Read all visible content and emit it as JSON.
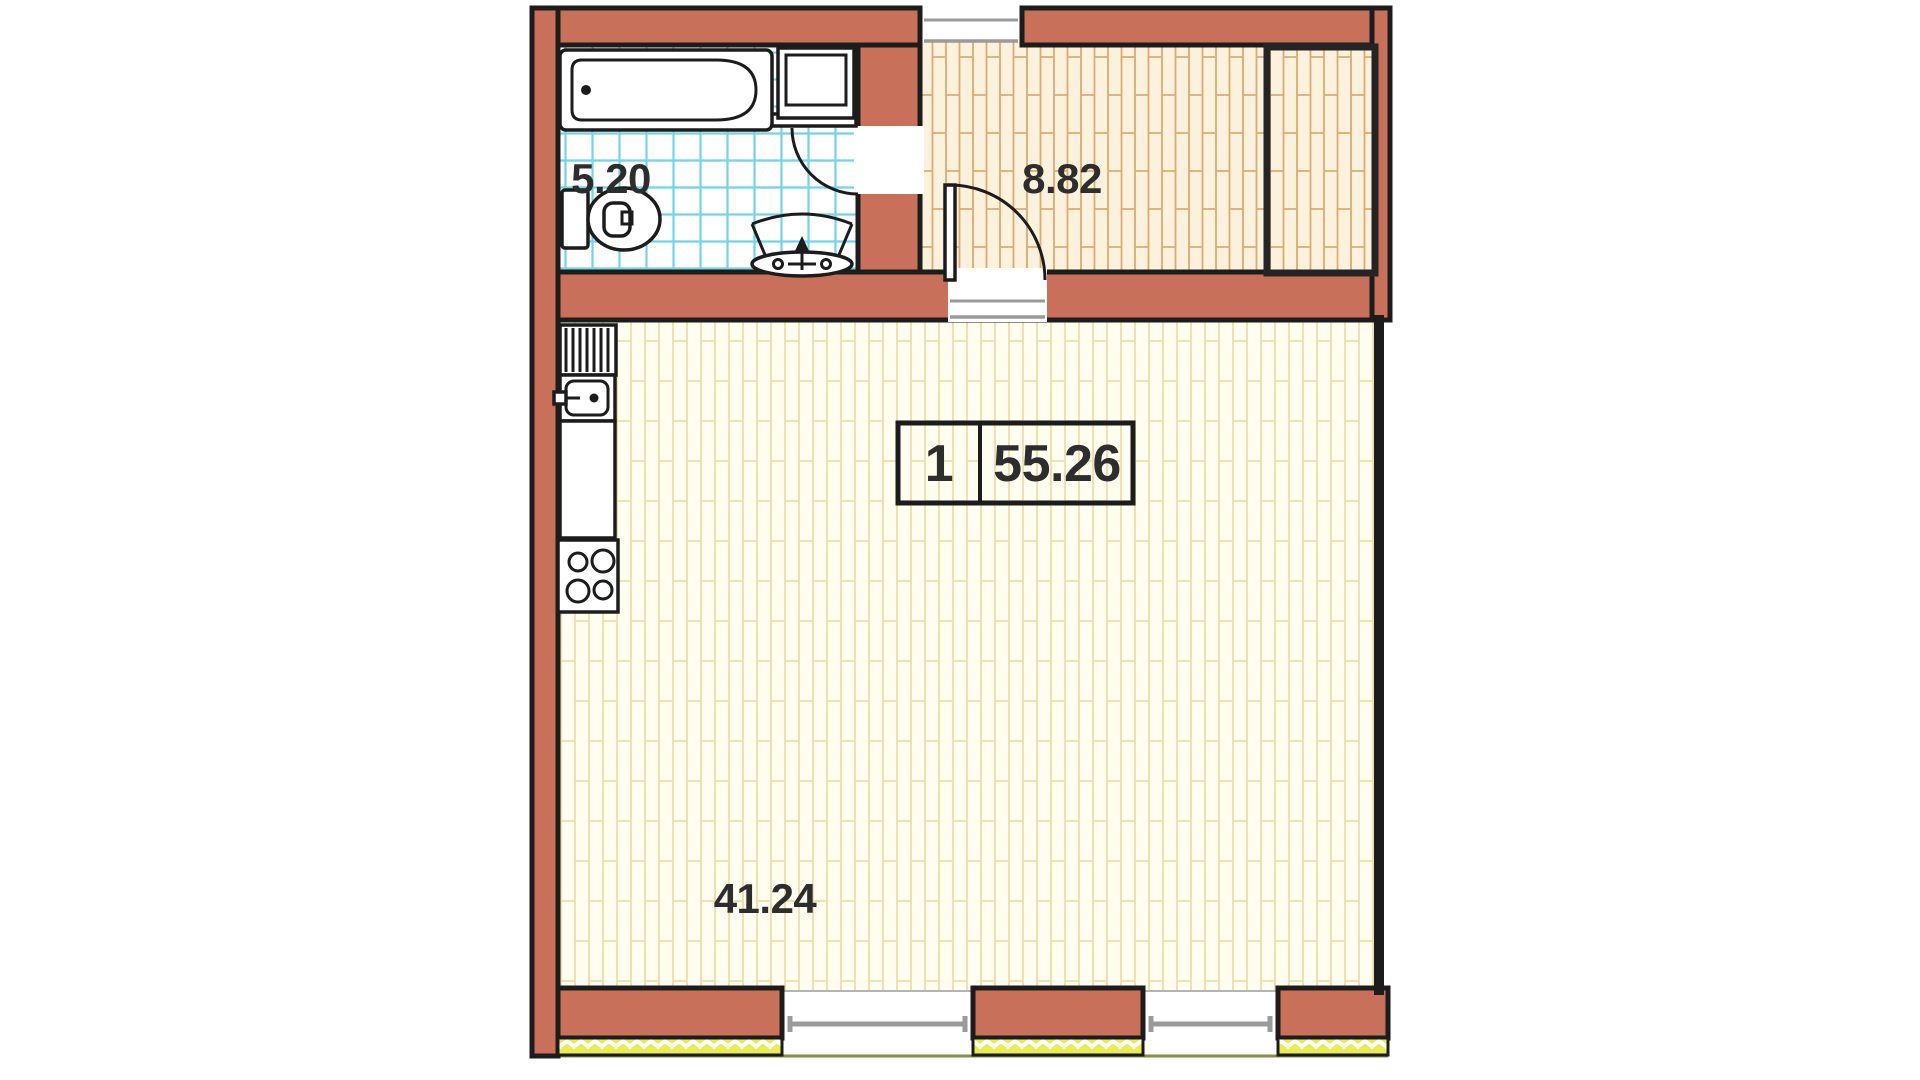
{
  "title": "apartment-floor-plan",
  "unit_info_box": {
    "unit_number": "1",
    "total_area_m2": "55.26"
  },
  "rooms": {
    "bathroom": {
      "area_label": "5.20"
    },
    "hallway": {
      "area_label": "8.82"
    },
    "living_room": {
      "area_label": "41.24"
    }
  },
  "fixtures": [
    "bathtub",
    "shower-cabin",
    "toilet",
    "washbasin",
    "kitchen-sink",
    "kitchen-counter",
    "stove-4-burners",
    "wardrobe-closet",
    "entrance-opening",
    "bathroom-door",
    "hallway-door",
    "window",
    "window"
  ],
  "colors": {
    "wall": "#c8705a",
    "outline": "#1c1c1c",
    "bath_tile_line": "#72d4e6",
    "hall_floor_bg": "#fbf1dc",
    "hall_floor_line": "#ddab70",
    "room_floor_bg": "#fffcf0",
    "room_floor_line": "#f1dcaa",
    "window_sill": "#e9ed55",
    "window_frame_gray": "#9a9a9a",
    "baseline_olive": "#8c8c4a",
    "label_text": "#2d2d2d"
  }
}
